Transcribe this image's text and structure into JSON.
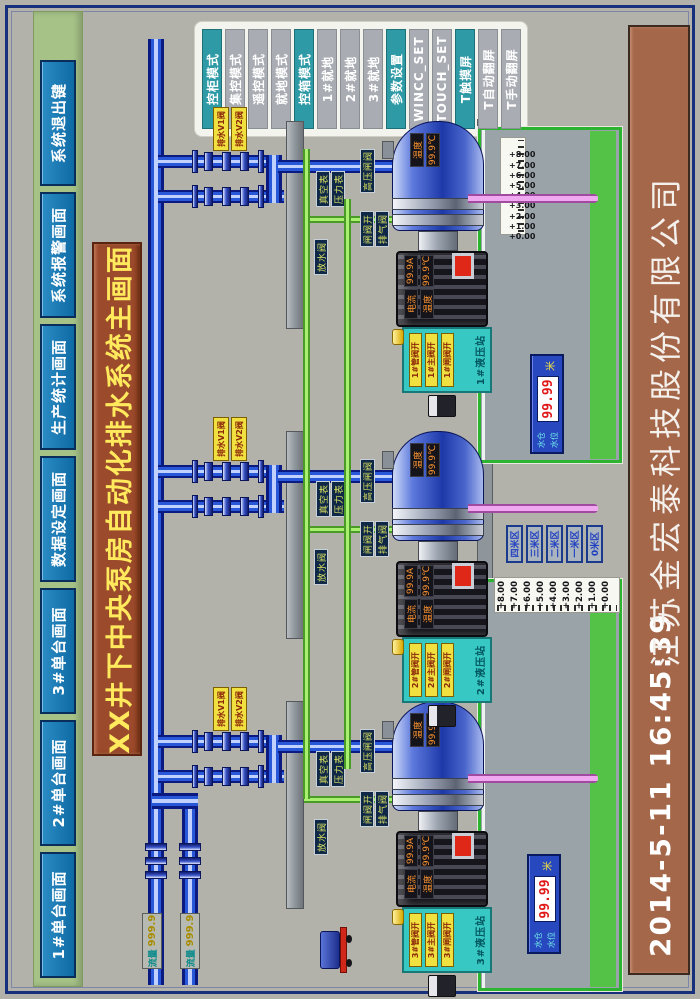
{
  "colors": {
    "accent_blue": "#1478b4",
    "title_bg": "#9c4a2c",
    "footer_bg": "#a5674a",
    "teal": "#2e9aa6",
    "panel_green": "#a6c287",
    "pipe_blue": "#2858d8",
    "pipe_green": "#aaf070",
    "alarm_red": "#e02818"
  },
  "title": "XX井下中央泵房自动化排水系统主画面",
  "nav": {
    "items": [
      "1#单台画面",
      "2#单台画面",
      "3#单台画面",
      "数据设定画面",
      "生产统计画面",
      "系统报警画面",
      "系统退出键"
    ]
  },
  "mode_panel": {
    "buttons": [
      {
        "label": "控柜模式",
        "style": "teal"
      },
      {
        "label": "集控模式",
        "style": "gray"
      },
      {
        "label": "遥控模式",
        "style": "gray"
      },
      {
        "label": "就地模式",
        "style": "gray"
      },
      {
        "label": "控箱模式",
        "style": "teal"
      },
      {
        "label": "1#就地",
        "style": "gray"
      },
      {
        "label": "2#就地",
        "style": "gray"
      },
      {
        "label": "3#就地",
        "style": "gray"
      },
      {
        "label": "参数设置",
        "style": "teal"
      },
      {
        "label": "WINCC_SET",
        "style": "gray"
      },
      {
        "label": "TOUCH_SET",
        "style": "gray"
      },
      {
        "label": "T触摸屏",
        "style": "teal"
      },
      {
        "label": "T自动翻屏",
        "style": "gray"
      },
      {
        "label": "T手动翻屏",
        "style": "gray"
      }
    ]
  },
  "footer": {
    "timestamp": "2014-5-11  16:45:39",
    "company": "江苏金宏泰科技股份有限公司"
  },
  "units": [
    {
      "id": "3#",
      "valve_tags": [
        "排水V1阀",
        "排水V2阀"
      ],
      "hydro": {
        "title": "3#液压站",
        "strips": [
          "3#管阀开",
          "3#主阀开",
          "3#闸阀开"
        ]
      },
      "pipe_labels": {
        "discharge": "高压闸阀",
        "vacuum": "真空表",
        "pressure": "压力表",
        "gate": "闸阀开",
        "vent": "排气阀",
        "drain": "放水阀"
      },
      "motor": {
        "current_label": "电流",
        "current_value": "99.9A",
        "temp_label": "温度",
        "temp_value": "99.9℃"
      },
      "pump": {
        "temp_label": "温度",
        "temp_value": "99.9℃"
      }
    },
    {
      "id": "2#",
      "valve_tags": [
        "排水V1阀",
        "排水V2阀"
      ],
      "hydro": {
        "title": "2#液压站",
        "strips": [
          "2#管阀开",
          "2#主阀开",
          "2#闸阀开"
        ]
      },
      "pipe_labels": {
        "discharge": "高压闸阀",
        "vacuum": "真空表",
        "pressure": "压力表",
        "gate": "闸阀开",
        "vent": "排气阀",
        "drain": "放水阀"
      },
      "motor": {
        "current_label": "电流",
        "current_value": "99.9A",
        "temp_label": "温度",
        "temp_value": "99.9℃"
      },
      "pump": {
        "temp_label": "温度",
        "temp_value": "99.9℃"
      }
    },
    {
      "id": "1#",
      "valve_tags": [
        "排水V1阀",
        "排水V2阀"
      ],
      "hydro": {
        "title": "1#液压站",
        "strips": [
          "1#管阀开",
          "1#主阀开",
          "1#闸阀开"
        ]
      },
      "pipe_labels": {
        "discharge": "高压闸阀",
        "vacuum": "真空表",
        "pressure": "压力表",
        "gate": "闸阀开",
        "vent": "排气阀",
        "drain": "放水阀"
      },
      "motor": {
        "current_label": "电流",
        "current_value": "99.9A",
        "temp_label": "温度",
        "temp_value": "99.9℃"
      },
      "pump": {
        "temp_label": "温度",
        "temp_value": "99.9℃"
      }
    }
  ],
  "sumps": [
    {
      "name": "右水仓",
      "ruler": [
        "+8.00",
        "+7.00",
        "+6.00",
        "+5.00",
        "+4.00",
        "+3.00",
        "+2.00",
        "+1.00",
        "+0.00"
      ],
      "level": {
        "labels": [
          "水仓",
          "水位"
        ],
        "value": "99.99",
        "unit": "米"
      }
    },
    {
      "name": "左水仓",
      "ruler": [
        "+8.00",
        "+7.00",
        "+6.00",
        "+5.00",
        "+4.00",
        "+3.00",
        "+2.00",
        "+1.00",
        "+0.00"
      ],
      "level": {
        "labels": [
          "水仓",
          "水位"
        ],
        "value": "99.99",
        "unit": "米"
      }
    }
  ],
  "zone_buttons": [
    "四米区",
    "三米区",
    "二米区",
    "一米区",
    "0米区"
  ],
  "flow_meters": [
    {
      "label": "流量",
      "value": "999.9"
    },
    {
      "label": "流量",
      "value": "999.9"
    }
  ]
}
